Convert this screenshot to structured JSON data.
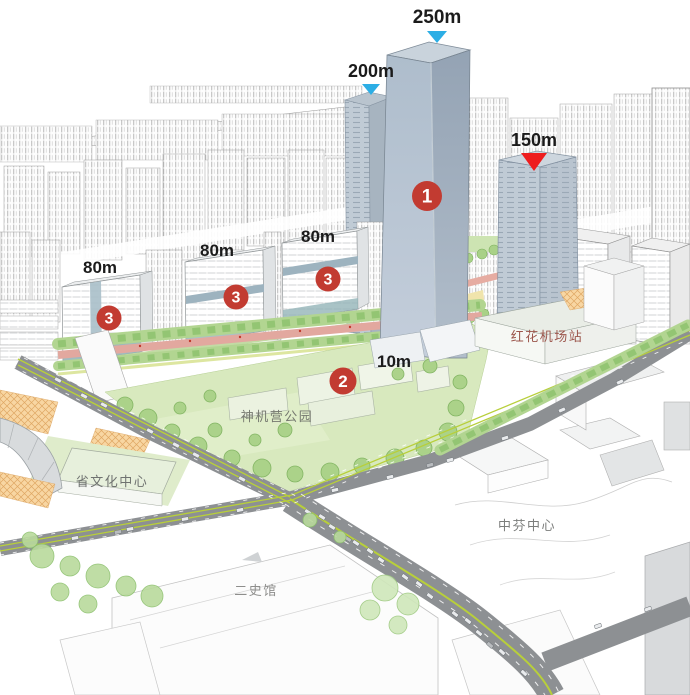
{
  "annotations": {
    "heights": [
      {
        "text": "250m",
        "arrow": "cyan"
      },
      {
        "text": "200m",
        "arrow": "cyan"
      },
      {
        "text": "150m",
        "arrow": "red"
      },
      {
        "text": "80m"
      },
      {
        "text": "80m"
      },
      {
        "text": "80m"
      },
      {
        "text": "10m"
      }
    ],
    "markers": [
      {
        "number": "1"
      },
      {
        "number": "2"
      },
      {
        "number": "3"
      },
      {
        "number": "3"
      },
      {
        "number": "3"
      }
    ],
    "places": [
      {
        "text": "红花机场站",
        "color": "#9c564c"
      },
      {
        "text": "神机营公园",
        "color": "#75786f"
      },
      {
        "text": "省文化中心",
        "color": "#6f7270"
      },
      {
        "text": "中芬中心",
        "color": "#7b7d7b"
      },
      {
        "text": "二史馆",
        "color": "#8e8e8c"
      }
    ]
  },
  "colors": {
    "arrow_cyan": "#2caee5",
    "arrow_red": "#ee1d1e",
    "marker_red": "#c23b31",
    "marker_text": "#ffffff",
    "tower_glass_blue": "#aebdcc",
    "park_green": "#d8e9be",
    "road_gray": "#8d9093",
    "lane_yellow_green": "#b8cf3a",
    "avenue_pink": "#dda69c",
    "plaza_orange": "#f8d6a2",
    "height_label_text": "#1b1b1b"
  }
}
